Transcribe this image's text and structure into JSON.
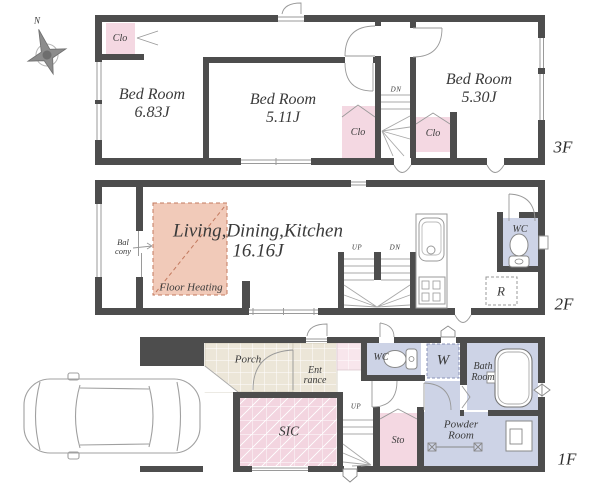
{
  "compass": {
    "north": "N"
  },
  "floor3": {
    "label": "3F",
    "bedroom_left": {
      "name": "Bed Room",
      "area": "6.83J"
    },
    "bedroom_mid": {
      "name": "Bed Room",
      "area": "5.11J"
    },
    "bedroom_right": {
      "name": "Bed Room",
      "area": "5.30J"
    },
    "closet_topleft": {
      "label": "Clo"
    },
    "closet_mid": {
      "label": "Clo"
    },
    "closet_right": {
      "label": "Clo"
    },
    "stairs": {
      "dn": "DN"
    }
  },
  "floor2": {
    "label": "2F",
    "ldk": {
      "name": "Living,Dining,Kitchen",
      "area": "16.16J"
    },
    "floor_heating": {
      "label": "Floor Heating"
    },
    "balcony": {
      "line1": "Bal",
      "line2": "cony"
    },
    "stairs": {
      "up": "UP",
      "dn": "DN"
    },
    "wc": {
      "label": "WC"
    },
    "refrigerator": {
      "label": "R"
    }
  },
  "floor1": {
    "label": "1F",
    "porch": {
      "label": "Porch"
    },
    "entrance": {
      "line1": "Ent",
      "line2": "rance"
    },
    "sic": {
      "label": "SIC"
    },
    "wc": {
      "label": "WC"
    },
    "washer": {
      "label": "W"
    },
    "storage": {
      "label": "Sto"
    },
    "bath": {
      "line1": "Bath",
      "line2": "Room"
    },
    "powder": {
      "line1": "Powder",
      "line2": "Room"
    },
    "stairs": {
      "up": "UP"
    }
  },
  "colors": {
    "wall": "#4d4d4d",
    "closet_pink": "#f4d8e2",
    "floor_heating_salmon": "#f1cab9",
    "heating_outline": "#c3795e",
    "sanitary_lavender": "#cdd3e6",
    "tile_beige": "#ece6d8",
    "tile_pale_pink": "#f8e6ec",
    "line_gray": "#999999",
    "text": "#3a3a3a"
  }
}
